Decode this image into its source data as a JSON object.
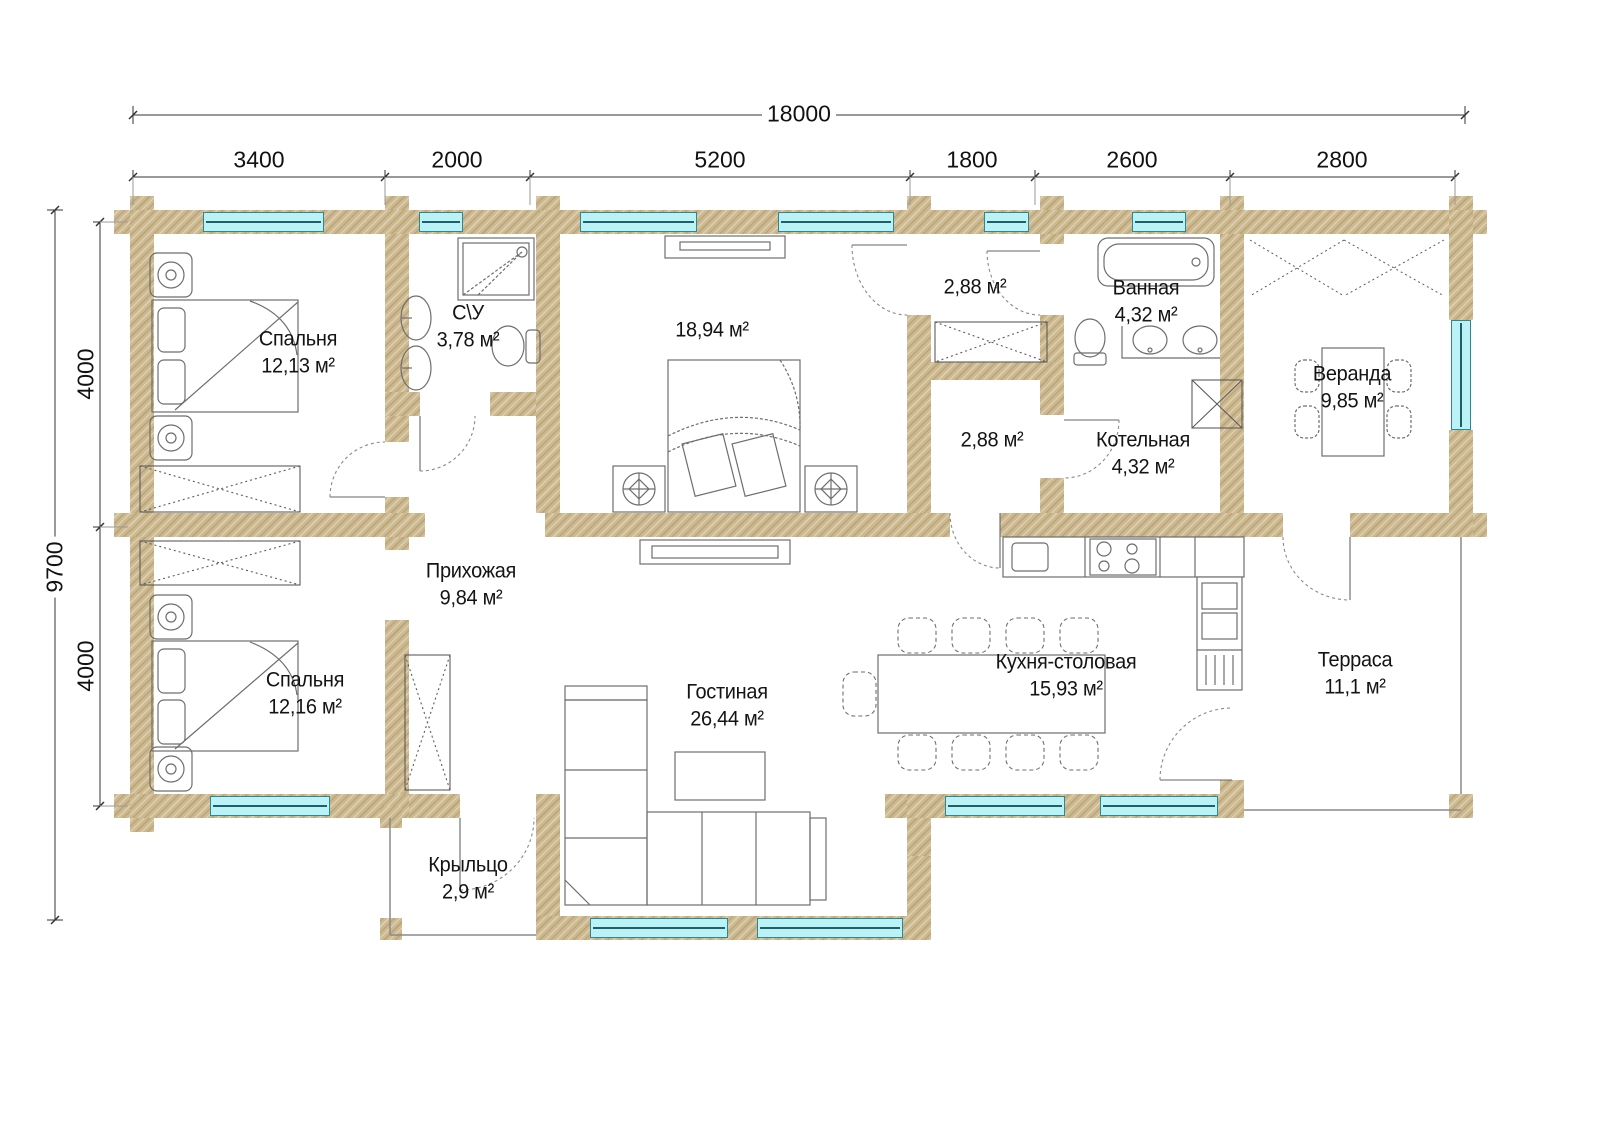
{
  "dimensions": {
    "overall_width": "18000",
    "overall_height": "9700",
    "width_segments": [
      "3400",
      "2000",
      "5200",
      "1800",
      "2600",
      "2800"
    ],
    "height_segments": [
      "4000",
      "4000"
    ]
  },
  "rooms": [
    {
      "id": "bedroom-1",
      "name": "Спальня",
      "area": "12,13 м²"
    },
    {
      "id": "wc",
      "name": "С\\У",
      "area": "3,78 м²"
    },
    {
      "id": "bedroom-3",
      "name": "",
      "area": "18,94 м²"
    },
    {
      "id": "corridor-upper",
      "name": "",
      "area": "2,88 м²"
    },
    {
      "id": "bathroom",
      "name": "Ванная",
      "area": "4,32 м²"
    },
    {
      "id": "veranda",
      "name": "Веранда",
      "area": "9,85 м²"
    },
    {
      "id": "corridor-lower",
      "name": "",
      "area": "2,88 м²"
    },
    {
      "id": "boiler-room",
      "name": "Котельная",
      "area": "4,32 м²"
    },
    {
      "id": "hallway",
      "name": "Прихожая",
      "area": "9,84 м²"
    },
    {
      "id": "bedroom-2",
      "name": "Спальня",
      "area": "12,16 м²"
    },
    {
      "id": "living-room",
      "name": "Гостиная",
      "area": "26,44 м²"
    },
    {
      "id": "kitchen-dining",
      "name": "Кухня-столовая",
      "area": "15,93 м²"
    },
    {
      "id": "terrace",
      "name": "Терраса",
      "area": "11,1 м²"
    },
    {
      "id": "porch",
      "name": "Крыльцо",
      "area": "2,9 м²"
    }
  ],
  "colors": {
    "wall": "#cdb98f",
    "window_fill": "#baf2f5",
    "window_border": "#2f8793",
    "furniture_line": "#6e6e6e",
    "dimension_line": "#333333",
    "text": "#141414"
  }
}
